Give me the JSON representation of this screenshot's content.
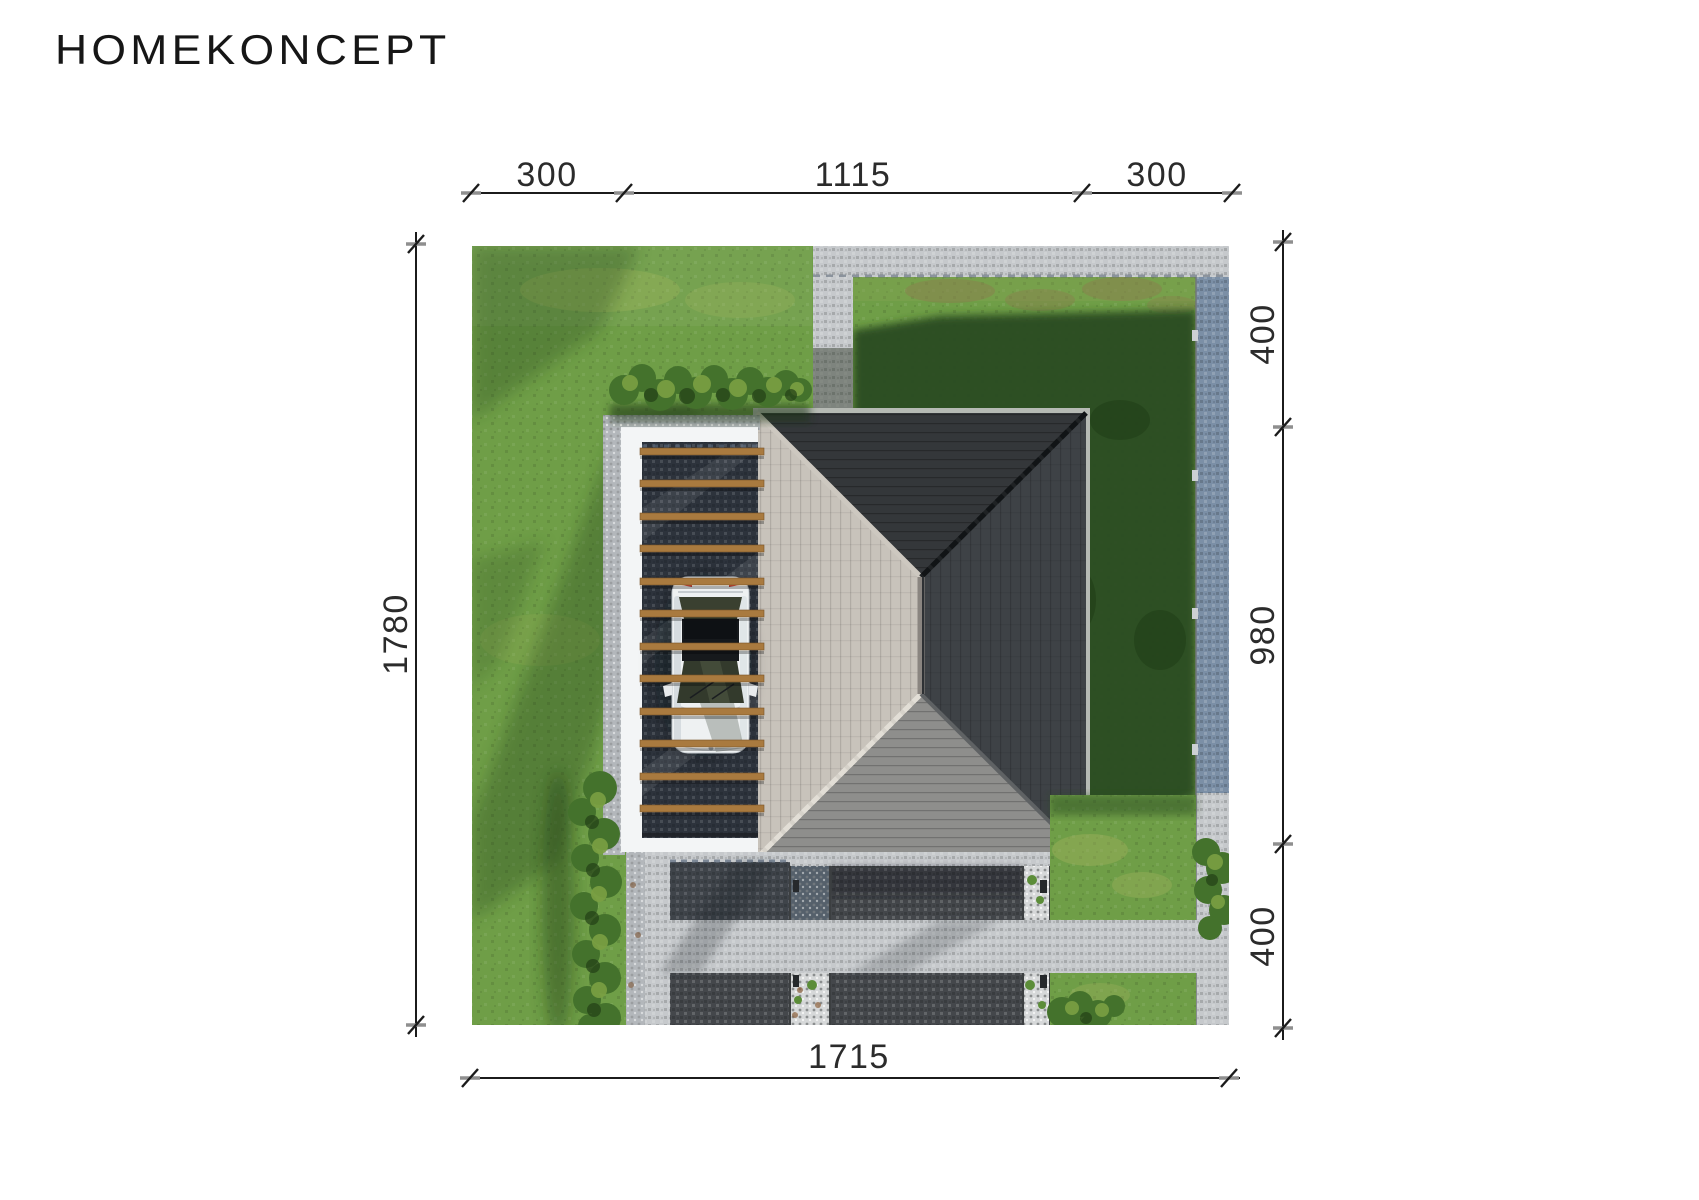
{
  "logo": {
    "text": "HOMEKONCEPT"
  },
  "dimensions": {
    "top": [
      "300",
      "1115",
      "300"
    ],
    "left": [
      "1780"
    ],
    "right": [
      "400",
      "980",
      "400"
    ],
    "bottom": [
      "1715"
    ]
  },
  "colors": {
    "background": "#ffffff",
    "dimension_line": "#1b1b1b",
    "dimension_text": "#2b2b2b",
    "grass_sunlit": "#6f9e47",
    "grass_shadow": "#2c4c20",
    "paving_light": "#c6c9cc",
    "paving_blue": "#7b8fa6",
    "paving_dark": "#44474b",
    "gravel_light": "#b3b7bb",
    "gravel_dark": "#2d3138",
    "pebble_light": "#d6d8d9",
    "carport_white": "#f3f5f6",
    "beam_wood": "#a97a3f",
    "roof_light": "#c8c3bb",
    "roof_north": "#34373a",
    "roof_east": "#3e4246",
    "roof_south": "#8e8e8c",
    "hedge_green": "#44722c",
    "car_white": "#eef1f2"
  }
}
